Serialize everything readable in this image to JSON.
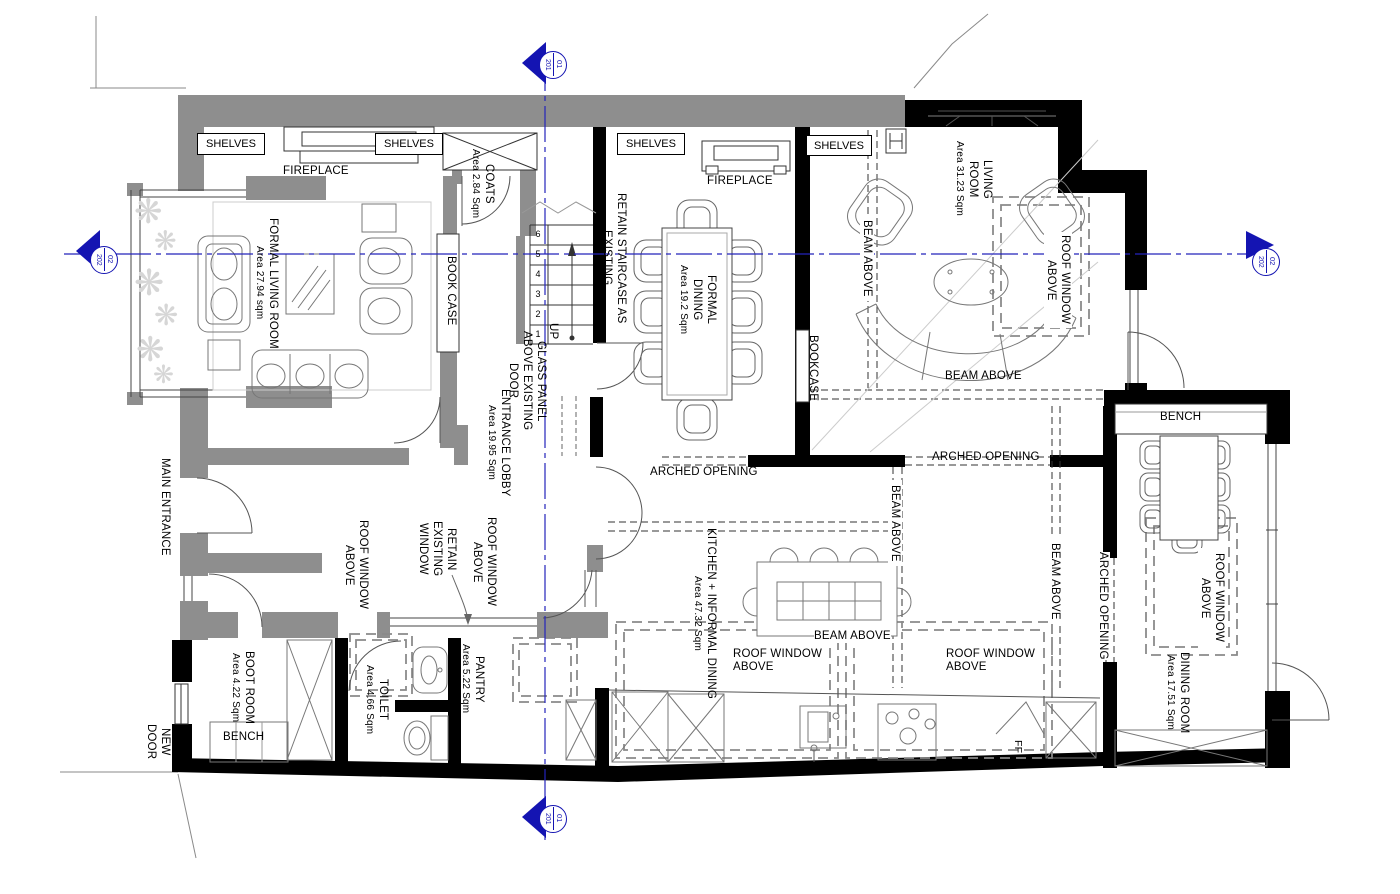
{
  "drawing": {
    "colors": {
      "existing_wall": "#8e8e8e",
      "new_wall": "#000000",
      "marker_blue": "#1414b2",
      "centerline_blue": "#2323bb"
    },
    "markers": {
      "top": {
        "num": "01",
        "sheet": "201"
      },
      "bottom": {
        "num": "01",
        "sheet": "201"
      },
      "left": {
        "num": "02",
        "sheet": "202"
      },
      "right": {
        "num": "02",
        "sheet": "202"
      }
    },
    "stairs": {
      "direction": "UP",
      "numbers": [
        "6",
        "5",
        "4",
        "3",
        "2",
        "1"
      ]
    },
    "rooms": {
      "formal_living": {
        "name": "FORMAL LIVING ROOM",
        "area": "Area 27.94 sqm"
      },
      "entrance_lobby": {
        "name": "ENTRANCE LOBBY",
        "area": "Area 19.95 Sqm"
      },
      "coats": {
        "name": "COATS",
        "area": "Area 2.84 Sqm"
      },
      "formal_dining": {
        "name": "FORMAL DINING",
        "area": "Area 19.2 Sqm"
      },
      "living_room": {
        "name": "LIVING ROOM",
        "area": "Area 31.23 Sqm"
      },
      "kitchen": {
        "name": "KITCHEN + INFORMAL DINING",
        "area": "Area 47.32 Sqm"
      },
      "dining_room": {
        "name": "DINING ROOM",
        "area": "Area 17.51 Sqm"
      },
      "boot_room": {
        "name": "BOOT ROOM",
        "area": "Area 4.22 Sqm"
      },
      "toilet": {
        "name": "TOILET",
        "area": "Area 4.66 Sqm"
      },
      "pantry": {
        "name": "PANTRY",
        "area": "Area 5.22 Sqm"
      }
    },
    "labels": {
      "shelves": "SHELVES",
      "fireplace": "FIREPLACE",
      "book_case": "BOOK CASE",
      "bookcase": "BOOKCASE",
      "bench": "BENCH",
      "beam_above": "BEAM ABOVE",
      "roof_window_above": "ROOF WINDOW ABOVE",
      "arched_opening": "ARCHED OPENING",
      "retain_staircase": "RETAIN STAIRCASE AS EXISTING",
      "glass_panel": "GLASS PANEL ABOVE EXISTING DOOR",
      "retain_window": "RETAIN EXISTING WINDOW",
      "main_entrance": "MAIN ENTRANCE",
      "new_door": "NEW DOOR",
      "up": "UP",
      "fridge_freezer": "FF"
    }
  }
}
